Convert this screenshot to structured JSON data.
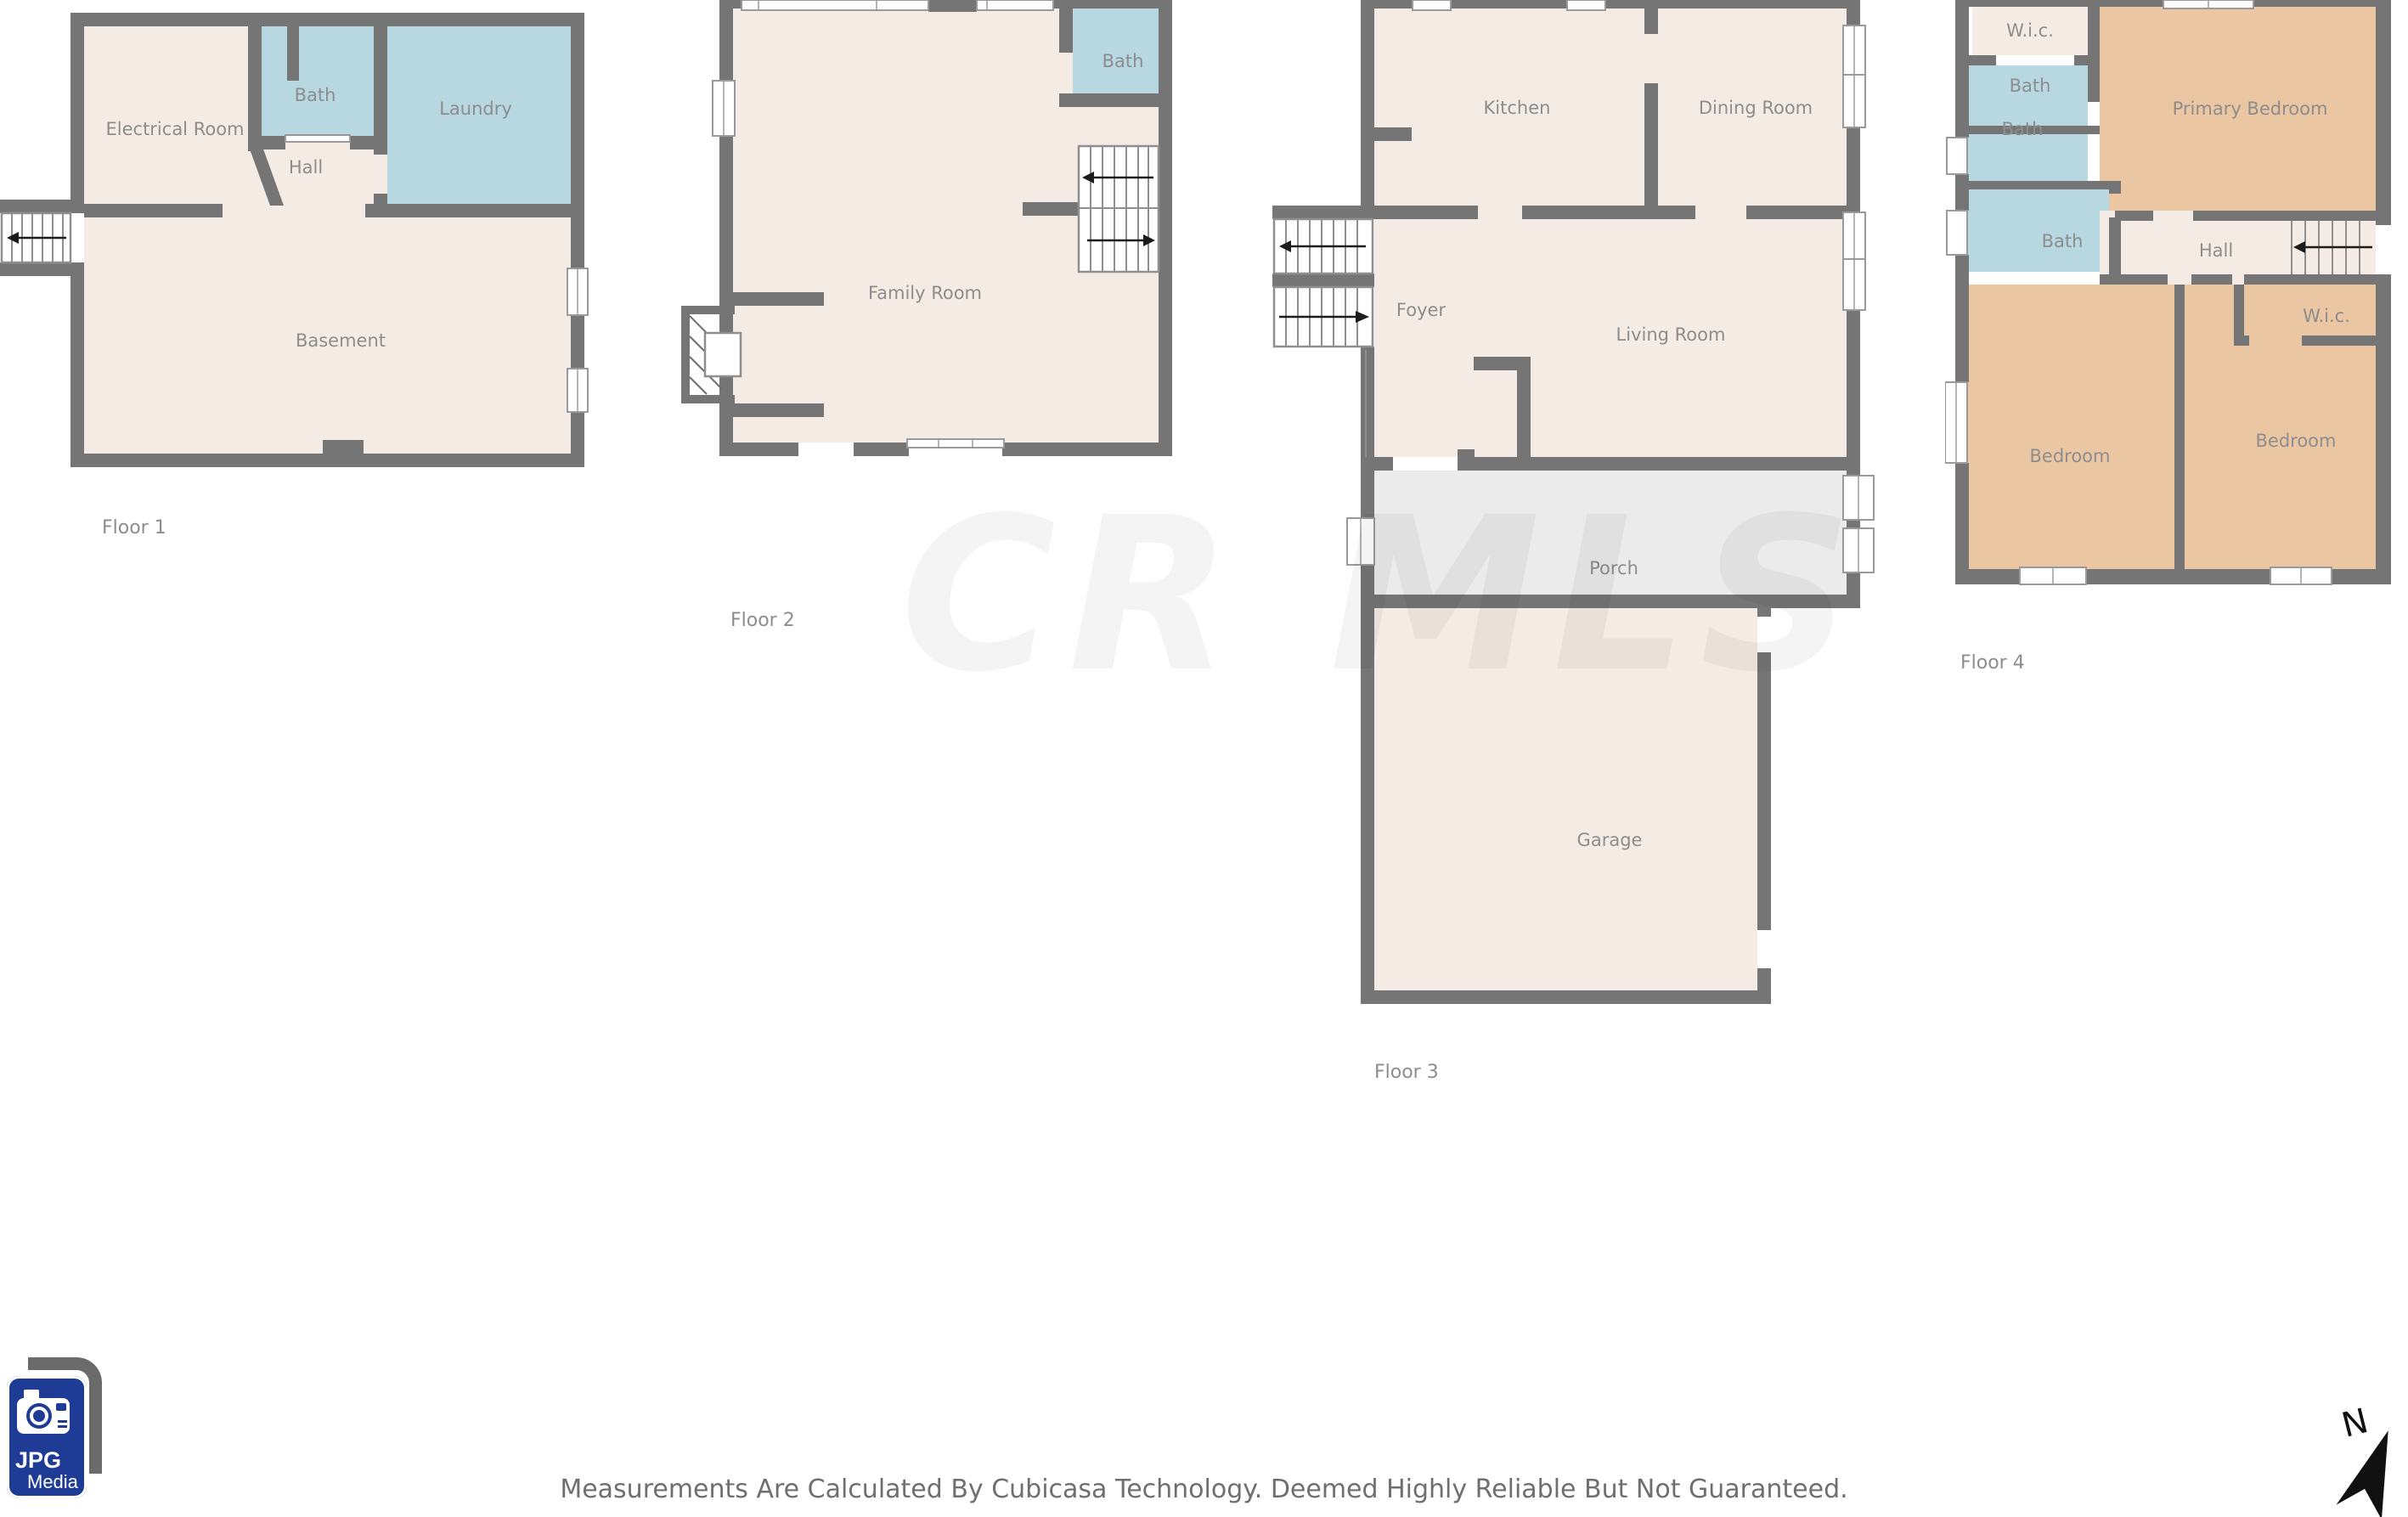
{
  "title": "Cubicasa multi-floor floor plan",
  "watermark": "CR MLS",
  "footer": "Measurements Are Calculated By Cubicasa Technology. Deemed Highly Reliable But Not Guaranteed.",
  "logo": {
    "icon": "camera-icon",
    "line1": "JPG",
    "line2": "Media"
  },
  "compass": {
    "label": "N"
  },
  "colors": {
    "wall": "#757575",
    "floor": "#f4ebe4",
    "wet": "#b7d7e1",
    "bedroom": "#eac6a3",
    "porch": "#ebebeb",
    "label": "#8d8d8d",
    "logo-blue": "#1e3c96",
    "logo-gray": "#6b6b6b"
  },
  "floors": [
    {
      "label": "Floor 1",
      "rooms": [
        "Electrical Room",
        "Bath",
        "Laundry",
        "Hall",
        "Basement"
      ]
    },
    {
      "label": "Floor 2",
      "rooms": [
        "Bath",
        "Family Room"
      ]
    },
    {
      "label": "Floor 3",
      "rooms": [
        "Kitchen",
        "Dining Room",
        "Foyer",
        "Living Room",
        "Porch",
        "Garage"
      ]
    },
    {
      "label": "Floor 4",
      "rooms": [
        "W.i.c.",
        "Bath",
        "Bath",
        "Bath",
        "Primary Bedroom",
        "Hall",
        "W.i.c.",
        "Bedroom",
        "Bedroom"
      ]
    }
  ]
}
